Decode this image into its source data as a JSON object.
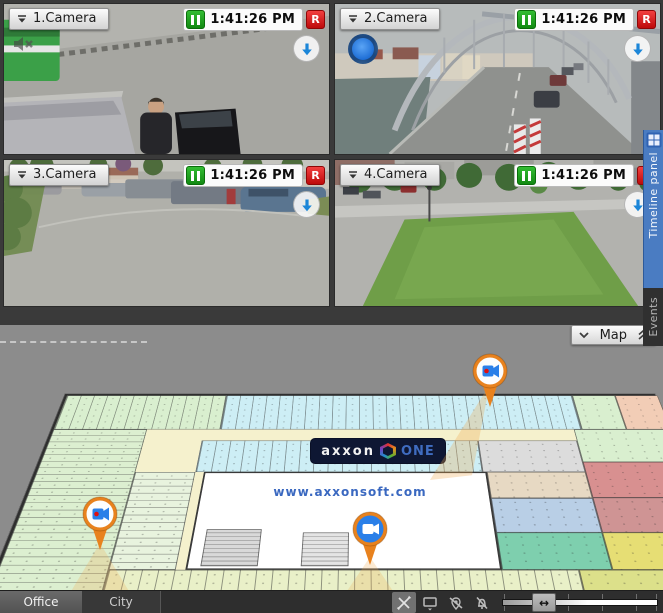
{
  "cameras": [
    {
      "name": "1.Camera",
      "time": "1:41:26 PM",
      "record": "R"
    },
    {
      "name": "2.Camera",
      "time": "1:41:26 PM",
      "record": "R"
    },
    {
      "name": "3.Camera",
      "time": "1:41:26 PM",
      "record": "R"
    },
    {
      "name": "4.Camera",
      "time": "1:41:26 PM",
      "record": "R"
    }
  ],
  "right_panel": {
    "timeline_tab_label": "Timeline panel",
    "events_tab_label": "Events"
  },
  "map": {
    "button_label": "Map",
    "logo_primary": "axxon",
    "logo_secondary": "ONE",
    "website": "www.axxonsoft.com",
    "markers": [
      {
        "icon": "camera-marker",
        "position": "top-right"
      },
      {
        "icon": "camera-marker",
        "position": "bottom-left"
      },
      {
        "icon": "camera-marker",
        "position": "bottom-center"
      }
    ]
  },
  "bottom_bar": {
    "tabs": [
      {
        "label": "Office",
        "active": true
      },
      {
        "label": "City",
        "active": false
      }
    ],
    "zoom_handle_glyph": "↔"
  },
  "colors": {
    "pause_green": "#17a317",
    "record_red": "#d81414",
    "panel_blue": "#4a7cc2",
    "marker_orange": "#e8821e"
  }
}
